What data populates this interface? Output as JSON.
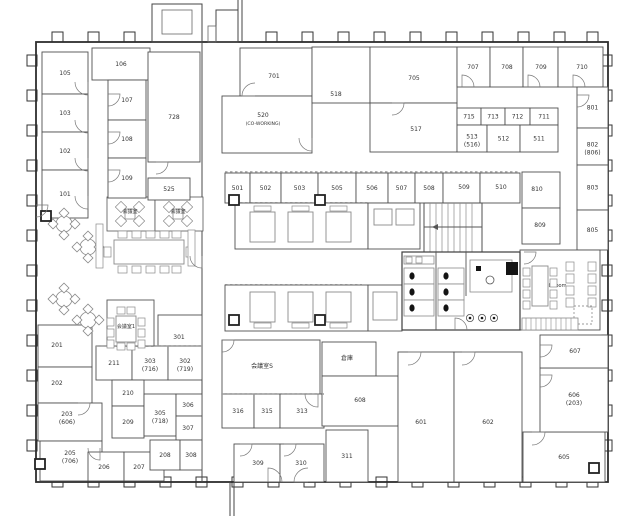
{
  "colors": {
    "background": "#ffffff",
    "outer_wall": "#2e2e2e",
    "partition": "#5a5a5a",
    "light_line": "#8a8a8a",
    "text": "#333333",
    "fixture": "#141414"
  },
  "rooms": [
    {
      "label": "105",
      "x": 42,
      "y": 52,
      "w": 46,
      "h": 42
    },
    {
      "label": "103",
      "x": 42,
      "y": 94,
      "w": 46,
      "h": 38
    },
    {
      "label": "102",
      "x": 42,
      "y": 132,
      "w": 46,
      "h": 38
    },
    {
      "label": "101",
      "x": 42,
      "y": 170,
      "w": 46,
      "h": 48
    },
    {
      "label": "106",
      "x": 92,
      "y": 48,
      "w": 58,
      "h": 32
    },
    {
      "label": "107",
      "x": 108,
      "y": 80,
      "w": 38,
      "h": 40
    },
    {
      "label": "108",
      "x": 108,
      "y": 120,
      "w": 38,
      "h": 38
    },
    {
      "label": "109",
      "x": 108,
      "y": 158,
      "w": 38,
      "h": 40
    },
    {
      "label": "728",
      "x": 148,
      "y": 52,
      "w": 52,
      "h": 110,
      "lx": 174,
      "ly": 119
    },
    {
      "label": "525",
      "x": 148,
      "y": 178,
      "w": 42,
      "h": 22
    },
    {
      "label": "701",
      "x": 240,
      "y": 48,
      "w": 72,
      "h": 48,
      "lx": 274,
      "ly": 78
    },
    {
      "label": "520",
      "sub": "(CO-WORKING)",
      "x": 222,
      "y": 96,
      "w": 90,
      "h": 57,
      "lx": 263,
      "ly": 119
    },
    {
      "label": "518",
      "x": 312,
      "y": 47,
      "w": 58,
      "h": 56,
      "lx": 336,
      "ly": 96
    },
    {
      "label": "705",
      "x": 370,
      "y": 47,
      "w": 87,
      "h": 56,
      "lx": 414,
      "ly": 80
    },
    {
      "label": "517",
      "x": 370,
      "y": 103,
      "w": 87,
      "h": 49,
      "lx": 416,
      "ly": 131
    },
    {
      "label": "707",
      "x": 457,
      "y": 47,
      "w": 33,
      "h": 40,
      "lx": 473,
      "ly": 69
    },
    {
      "label": "708",
      "x": 490,
      "y": 47,
      "w": 33,
      "h": 40,
      "lx": 507,
      "ly": 69
    },
    {
      "label": "709",
      "x": 523,
      "y": 47,
      "w": 35,
      "h": 40,
      "lx": 541,
      "ly": 69
    },
    {
      "label": "710",
      "x": 558,
      "y": 47,
      "w": 45,
      "h": 40,
      "lx": 582,
      "ly": 69
    },
    {
      "label": "715",
      "x": 457,
      "y": 108,
      "w": 24,
      "h": 17
    },
    {
      "label": "713",
      "x": 481,
      "y": 108,
      "w": 24,
      "h": 17
    },
    {
      "label": "712",
      "x": 505,
      "y": 108,
      "w": 25,
      "h": 17
    },
    {
      "label": "711",
      "x": 530,
      "y": 108,
      "w": 28,
      "h": 17
    },
    {
      "label": "513",
      "sub": "(516)",
      "x": 457,
      "y": 125,
      "w": 30,
      "h": 27
    },
    {
      "label": "512",
      "x": 487,
      "y": 125,
      "w": 33,
      "h": 27
    },
    {
      "label": "511",
      "x": 520,
      "y": 125,
      "w": 38,
      "h": 27
    },
    {
      "label": "801",
      "x": 577,
      "y": 87,
      "w": 31,
      "h": 41
    },
    {
      "label": "802",
      "sub": "(806)",
      "x": 577,
      "y": 128,
      "w": 31,
      "h": 37
    },
    {
      "label": "803",
      "x": 577,
      "y": 165,
      "w": 31,
      "h": 45
    },
    {
      "label": "805",
      "x": 577,
      "y": 210,
      "w": 31,
      "h": 40
    },
    {
      "label": "501",
      "x": 225,
      "y": 173,
      "w": 25,
      "h": 30
    },
    {
      "label": "502",
      "x": 250,
      "y": 173,
      "w": 31,
      "h": 30
    },
    {
      "label": "503",
      "x": 281,
      "y": 173,
      "w": 37,
      "h": 30
    },
    {
      "label": "505",
      "x": 318,
      "y": 173,
      "w": 38,
      "h": 30
    },
    {
      "label": "506",
      "x": 356,
      "y": 173,
      "w": 32,
      "h": 30
    },
    {
      "label": "507",
      "x": 388,
      "y": 173,
      "w": 27,
      "h": 30
    },
    {
      "label": "508",
      "x": 415,
      "y": 173,
      "w": 28,
      "h": 30
    },
    {
      "label": "509",
      "x": 443,
      "y": 173,
      "w": 37,
      "h": 30,
      "lx": 464,
      "ly": 189
    },
    {
      "label": "510",
      "x": 480,
      "y": 173,
      "w": 40,
      "h": 30,
      "lx": 501,
      "ly": 189
    },
    {
      "label": "810",
      "x": 522,
      "y": 172,
      "w": 38,
      "h": 36,
      "lx": 537,
      "ly": 191
    },
    {
      "label": "809",
      "x": 522,
      "y": 208,
      "w": 38,
      "h": 36,
      "lx": 540,
      "ly": 227
    },
    {
      "label": "201",
      "x": 38,
      "y": 325,
      "w": 54,
      "h": 42,
      "lx": 57,
      "ly": 347
    },
    {
      "label": "202",
      "x": 38,
      "y": 367,
      "w": 54,
      "h": 36,
      "lx": 57,
      "ly": 385
    },
    {
      "label": "203",
      "sub": "(606)",
      "x": 38,
      "y": 403,
      "w": 64,
      "h": 38,
      "lx": 67,
      "ly": 418
    },
    {
      "label": "205",
      "sub": "(706)",
      "x": 40,
      "y": 441,
      "w": 62,
      "h": 40,
      "lx": 70,
      "ly": 457
    },
    {
      "label": "206",
      "x": 88,
      "y": 452,
      "w": 36,
      "h": 29,
      "lx": 104,
      "ly": 469
    },
    {
      "label": "207",
      "x": 124,
      "y": 452,
      "w": 40,
      "h": 29,
      "lx": 139,
      "ly": 469
    },
    {
      "label": "301",
      "x": 158,
      "y": 315,
      "w": 44,
      "h": 31,
      "lx": 179,
      "ly": 339
    },
    {
      "label": "211",
      "x": 96,
      "y": 346,
      "w": 36,
      "h": 34
    },
    {
      "label": "303",
      "sub": "(716)",
      "x": 132,
      "y": 346,
      "w": 36,
      "h": 34
    },
    {
      "label": "302",
      "sub": "(719)",
      "x": 168,
      "y": 346,
      "w": 34,
      "h": 34
    },
    {
      "label": "210",
      "x": 112,
      "y": 380,
      "w": 32,
      "h": 26
    },
    {
      "label": "209",
      "x": 112,
      "y": 406,
      "w": 32,
      "h": 32
    },
    {
      "label": "305",
      "sub": "(718)",
      "x": 144,
      "y": 394,
      "w": 32,
      "h": 42
    },
    {
      "label": "306",
      "x": 176,
      "y": 394,
      "w": 26,
      "h": 22,
      "lx": 188,
      "ly": 407
    },
    {
      "label": "307",
      "x": 176,
      "y": 416,
      "w": 26,
      "h": 24,
      "lx": 188,
      "ly": 430
    },
    {
      "label": "208",
      "x": 150,
      "y": 440,
      "w": 30,
      "h": 30
    },
    {
      "label": "308",
      "x": 180,
      "y": 440,
      "w": 22,
      "h": 30
    },
    {
      "label": "会議室S",
      "x": 222,
      "y": 340,
      "w": 98,
      "h": 54,
      "lx": 262,
      "ly": 368
    },
    {
      "label": "倉庫",
      "x": 322,
      "y": 342,
      "w": 54,
      "h": 34,
      "lx": 347,
      "ly": 360
    },
    {
      "label": "316",
      "x": 222,
      "y": 394,
      "w": 32,
      "h": 34
    },
    {
      "label": "315",
      "x": 254,
      "y": 394,
      "w": 26,
      "h": 34
    },
    {
      "label": "313",
      "x": 280,
      "y": 394,
      "w": 44,
      "h": 34
    },
    {
      "label": "309",
      "x": 234,
      "y": 444,
      "w": 46,
      "h": 38,
      "lx": 258,
      "ly": 465
    },
    {
      "label": "310",
      "x": 280,
      "y": 444,
      "w": 44,
      "h": 38,
      "lx": 301,
      "ly": 465
    },
    {
      "label": "311",
      "x": 326,
      "y": 430,
      "w": 42,
      "h": 52,
      "lx": 347,
      "ly": 458
    },
    {
      "label": "608",
      "x": 322,
      "y": 376,
      "w": 76,
      "h": 50,
      "lx": 360,
      "ly": 402
    },
    {
      "label": "601",
      "x": 398,
      "y": 352,
      "w": 56,
      "h": 130,
      "lx": 421,
      "ly": 424
    },
    {
      "label": "602",
      "x": 454,
      "y": 352,
      "w": 68,
      "h": 130,
      "lx": 488,
      "ly": 424
    },
    {
      "label": "605",
      "x": 523,
      "y": 432,
      "w": 82,
      "h": 50,
      "lx": 564,
      "ly": 459
    },
    {
      "label": "606",
      "sub": "(203)",
      "x": 540,
      "y": 368,
      "w": 68,
      "h": 64,
      "lx": 574,
      "ly": 399
    },
    {
      "label": "607",
      "x": 540,
      "y": 335,
      "w": 68,
      "h": 33,
      "lx": 575,
      "ly": 353
    },
    {
      "label": "club room",
      "x": 520,
      "y": 250,
      "w": 80,
      "h": 80,
      "lx": 554,
      "ly": 287
    }
  ],
  "area_labels": [
    {
      "text": "会議室",
      "x": 130,
      "y": 213
    },
    {
      "text": "会議室",
      "x": 178,
      "y": 213
    },
    {
      "text": "会議室1",
      "x": 126,
      "y": 328
    }
  ]
}
